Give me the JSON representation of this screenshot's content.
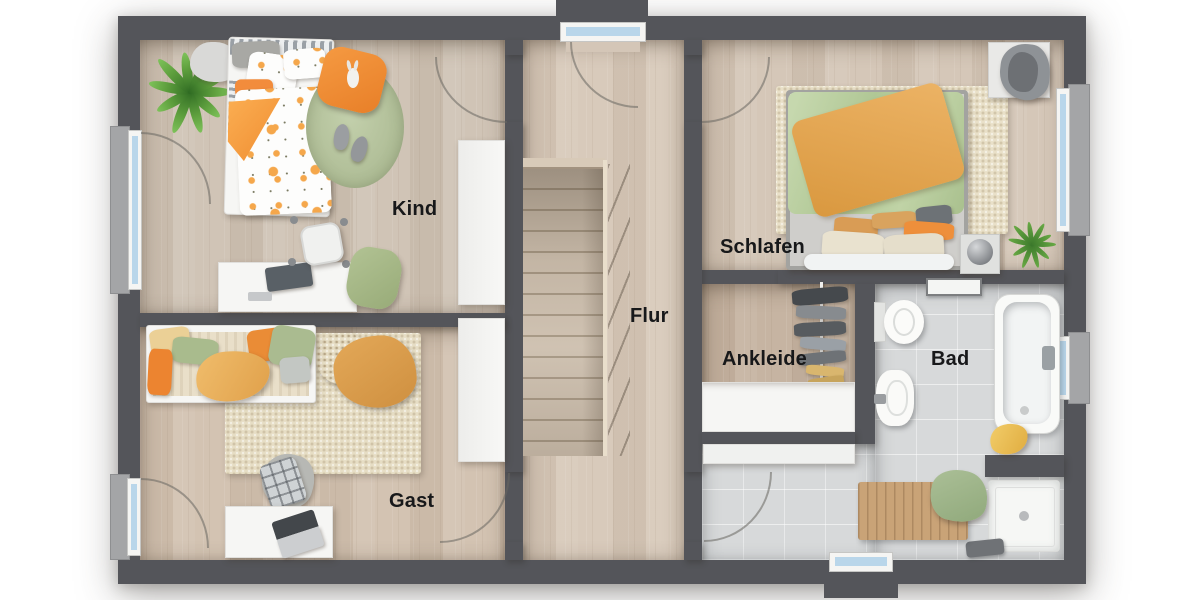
{
  "plan": {
    "type": "floor-plan-top-view",
    "rooms": [
      {
        "id": "kind",
        "label": "Kind"
      },
      {
        "id": "flur",
        "label": "Flur"
      },
      {
        "id": "schlafen",
        "label": "Schlafen"
      },
      {
        "id": "ankleide",
        "label": "Ankleide"
      },
      {
        "id": "bad",
        "label": "Bad"
      },
      {
        "id": "gast",
        "label": "Gast"
      }
    ],
    "palette": {
      "wall": "#54555a",
      "wood_floor_flur": "#d8cabb",
      "wood_floor_kind": "#d0c4b6",
      "wood_floor_gast": "#d3c3b2",
      "wood_floor_schlafen": "#d5c7b8",
      "wood_floor_ankleide": "#c6b4a2",
      "tile_floor_bad": "#d7d9da",
      "stair_tread": "#cdbfae",
      "window_glass": "#b9d6ea",
      "window_frame": "#f5f5f3",
      "window_sill": "#a4a5a7",
      "accent_orange": "#ec8c36",
      "accent_green": "#aabb90",
      "accent_mustard": "#ecb45e",
      "rug_cream": "#e6ddc4",
      "rug_round_green": "#aebc95",
      "label_color": "#17181a"
    },
    "windows": [
      "left-kind",
      "left-gast",
      "right-schlafen",
      "right-bad",
      "top-dormer-flur",
      "bottom-dormer-bad"
    ],
    "furniture": {
      "kind": [
        "palm-plant",
        "cloud-rug",
        "single-bed-polkadot",
        "round-rug",
        "orange-pillow",
        "bunny-toy",
        "slippers",
        "desk",
        "monitor",
        "desk-chair",
        "floor-cushion",
        "wardrobe"
      ],
      "gast": [
        "daybed",
        "pillows",
        "mustard-blanket",
        "straw-pouf",
        "caramel-throw",
        "cream-rug",
        "armchair",
        "plaid-pillow",
        "table",
        "laptop",
        "wardrobe"
      ],
      "schlafen": [
        "double-bed",
        "green-duvet",
        "orange-throw",
        "cream-rug",
        "bench-with-clothes",
        "nightstand",
        "sphere-lamp",
        "grass-plant"
      ],
      "ankleide": [
        "clothes-rail",
        "hanging-clothes",
        "dresser"
      ],
      "bad": [
        "towel-shelf",
        "toilet",
        "washbasin",
        "bathtub",
        "yellow-towel",
        "shower",
        "shower-fixture",
        "wooden-bath-mat",
        "green-towel"
      ]
    }
  }
}
